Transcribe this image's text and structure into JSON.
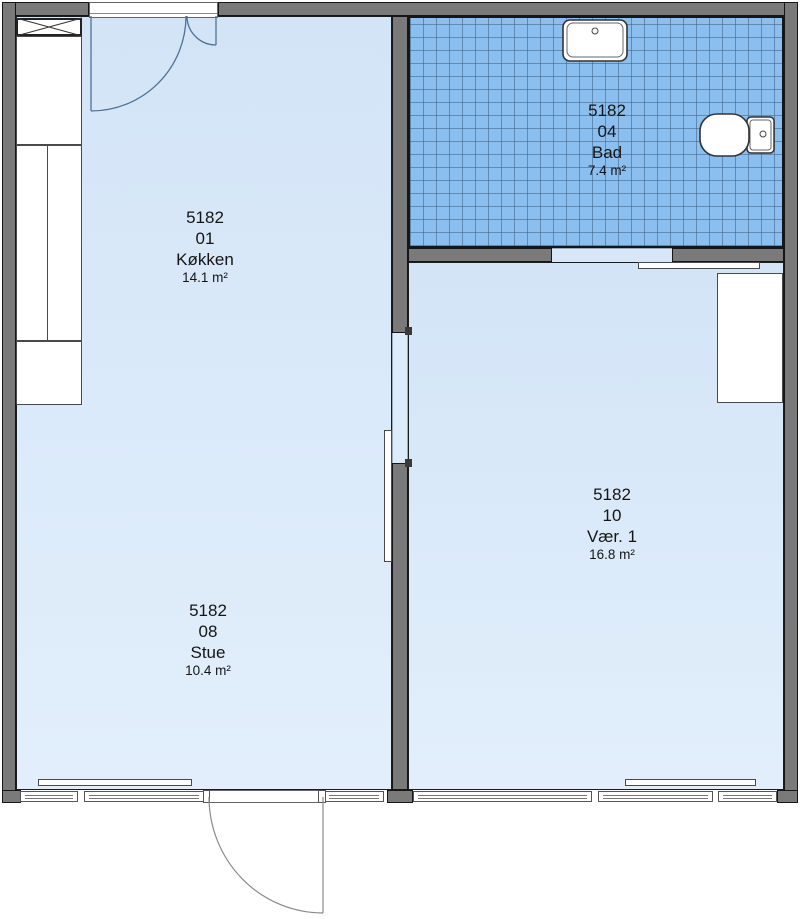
{
  "plan_title": "Apartment floor plan 5182",
  "rooms": [
    {
      "code": "5182",
      "number": "01",
      "name": "Køkken",
      "area": "14.1 m²"
    },
    {
      "code": "5182",
      "number": "04",
      "name": "Bad",
      "area": "7.4 m²"
    },
    {
      "code": "5182",
      "number": "08",
      "name": "Stue",
      "area": "10.4 m²"
    },
    {
      "code": "5182",
      "number": "10",
      "name": "Vær. 1",
      "area": "16.8 m²"
    }
  ],
  "fixtures": [
    "kitchen-crossbox-icon",
    "kitchen-counter",
    "bath-sink-icon",
    "bath-toilet-icon",
    "wardrobe",
    "radiator",
    "sliding-door",
    "entry-door",
    "double-entry-door",
    "window"
  ],
  "colors": {
    "room_fill": "#dcebfa",
    "bath_tile_fill": "#8bbfef",
    "wall_gray": "#7a7a7a",
    "outline_black": "#161616",
    "door_swing_line": "#4f7293",
    "fixture_white": "#ffffff"
  }
}
